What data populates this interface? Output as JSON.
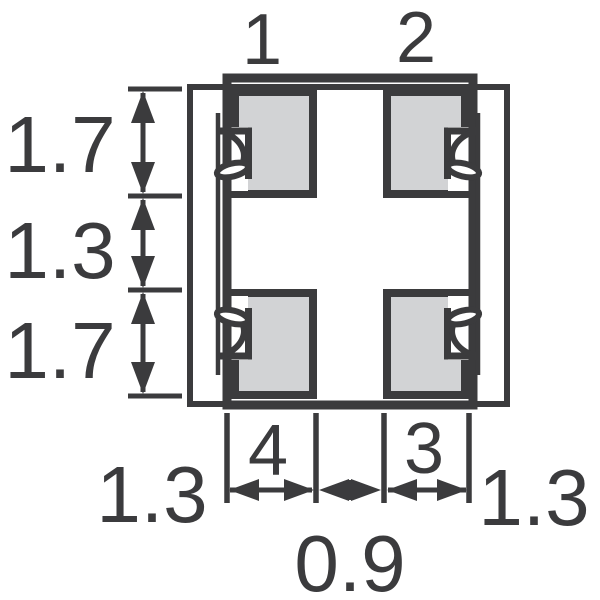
{
  "diagram": {
    "pins": {
      "top_left": "1",
      "top_right": "2",
      "bottom_right": "3",
      "bottom_left": "4"
    },
    "dims_left": {
      "top": "1.7",
      "middle": "1.3",
      "bottom": "1.7"
    },
    "dims_bottom": {
      "left_pad": "1.3",
      "center_gap": "0.9",
      "right_pad": "1.3"
    },
    "colors": {
      "line": "#3b3b3d",
      "pad_fill": "#d2d3d5",
      "background": "#ffffff"
    }
  }
}
